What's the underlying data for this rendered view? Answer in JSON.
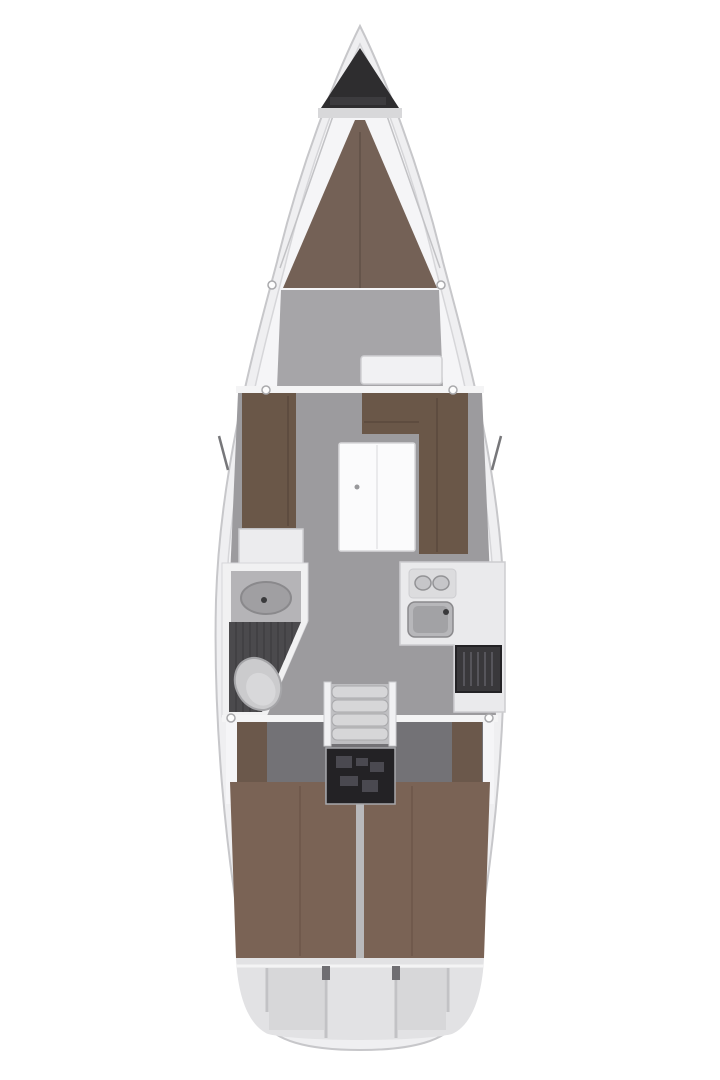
{
  "canvas": {
    "width": 720,
    "height": 1080
  },
  "diagram": {
    "type": "sailboat-interior-floor-plan",
    "orientation": "bow-up",
    "features": [
      "anchor-locker",
      "windlass",
      "v-berth",
      "forward-cabin-floor",
      "forward-bench",
      "port-settee",
      "starboard-l-settee",
      "salon-table",
      "port-cabinet",
      "head-counter",
      "head-sink",
      "toilet",
      "head-floor-grate",
      "galley-counter",
      "stove-burners",
      "galley-sink",
      "fridge-vent",
      "companionway-steps",
      "engine-compartment",
      "port-aft-berth",
      "starboard-aft-berth",
      "wardrobes",
      "stern-lazarette",
      "deck-fittings",
      "chainplates"
    ]
  },
  "colors": {
    "background": "#ffffff",
    "hull_fill": "#efeff1",
    "hull_stroke": "#c7c7ca",
    "deck_fill": "#f5f5f7",
    "deck_stroke": "#d6d6d9",
    "anchor_locker": "#2e2d2f",
    "windlass_band": "#d8d8da",
    "windlass_bar": "#3c3b3e",
    "rig_line": "#c2c2c5",
    "vberth": "#746156",
    "vberth_seam": "#605047",
    "fwd_floor": "#a6a5a8",
    "bench_fill": "#f1f1f3",
    "bench_stroke": "#cfcfd2",
    "bulkhead": "#f4f4f5",
    "salon_floor": "#9c9b9e",
    "settee": "#6a5748",
    "settee_seam": "#57453a",
    "cabinet": "#ececee",
    "cabinet_stroke": "#cfcfd2",
    "table_fill": "#fbfbfc",
    "table_stroke": "#d8d8da",
    "table_seam": "#e4e4e6",
    "table_dot": "#98989b",
    "head_wall": "#f1f1f2",
    "head_counter": "#b5b4b7",
    "sink_fill": "#a09fa2",
    "sink_stroke": "#8a898c",
    "faucet": "#3a3a3c",
    "head_floor": "#4b4a4d",
    "head_floor_stripe": "#3f3e41",
    "toilet_fill": "#cbcbcd",
    "toilet_stroke": "#a5a5a8",
    "toilet_inner": "#d8d8da",
    "galley_counter": "#eaeaec",
    "galley_stroke": "#cdcdd0",
    "stove_fill": "#dcdcde",
    "burner_fill": "#c6c6c9",
    "burner_stroke": "#939396",
    "galley_sink_outer": "#b7b7ba",
    "galley_sink_inner": "#a2a2a5",
    "fridge_fill": "#39383b",
    "fridge_stripe": "#56555b",
    "steps_frame": "#bfbfc2",
    "step_tread": "#d6d6d8",
    "step_shadow": "#a8a8ab",
    "engine_fill": "#232225",
    "engine_detail": "#4a4950",
    "aft_floor": "#737276",
    "wardrobe": "#6b584b",
    "aft_berth": "#7a6355",
    "berth_seam": "#6a5346",
    "berth_divider": "#b9b9bb",
    "stern_fill": "#e2e2e4",
    "stern_panel": "#d7d7d9",
    "stern_line": "#c2c2c5",
    "hinge_dark": "#6f6e72",
    "fitting_fill": "#fdfdfd",
    "fitting_stroke": "#a9a9ac",
    "chainplate": "#77777a"
  }
}
